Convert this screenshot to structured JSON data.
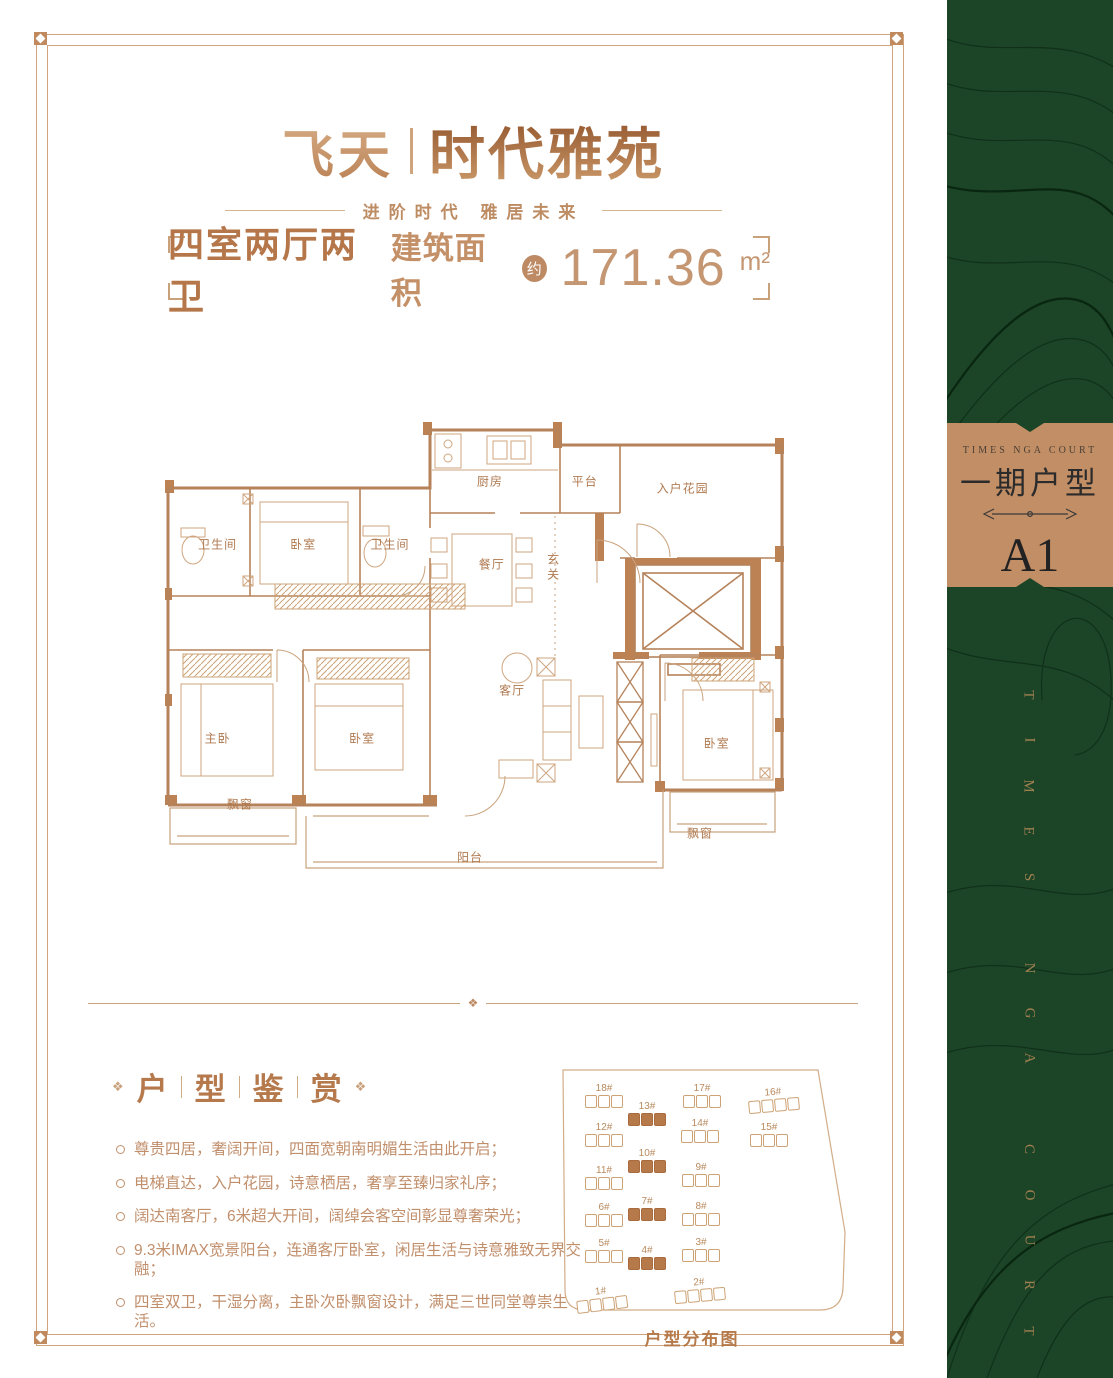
{
  "brand": {
    "name_left": "飞天",
    "name_right": "时代雅苑",
    "tagline": "进阶时代 雅居未来"
  },
  "spec": {
    "rooms_label": "四室两厅两卫",
    "area_label": "建筑面积",
    "approx": "约",
    "area_value": "171.36",
    "area_unit": "m²"
  },
  "floorplan": {
    "rooms": [
      {
        "label": "卫生间"
      },
      {
        "label": "卧室"
      },
      {
        "label": "卫生间"
      },
      {
        "label": "厨房"
      },
      {
        "label": "平台"
      },
      {
        "label": "入户花园"
      },
      {
        "label": "餐厅"
      },
      {
        "label": "玄关"
      },
      {
        "label": "主卧"
      },
      {
        "label": "卧室"
      },
      {
        "label": "客厅"
      },
      {
        "label": "卧室"
      },
      {
        "label": "飘窗"
      },
      {
        "label": "阳台"
      },
      {
        "label": "飘窗"
      }
    ]
  },
  "divider_ornament": "❖",
  "features": {
    "ornament": "❖",
    "heading": [
      "户",
      "型",
      "鉴",
      "赏"
    ],
    "items": [
      "尊贵四居，奢阔开间，四面宽朝南明媚生活由此开启；",
      "电梯直达，入户花园，诗意栖居，奢享至臻归家礼序；",
      "阔达南客厅，6米超大开间，阔绰会客空间彰显尊奢荣光；",
      "9.3米IMAX宽景阳台，连通客厅卧室，闲居生活与诗意雅致无界交融；",
      "四室双卫，干湿分离，主卧次卧飘窗设计，满足三世同堂尊崇生活。"
    ]
  },
  "siteplan": {
    "caption": "户型分布图",
    "buildings": [
      {
        "label": "18#",
        "filled": false
      },
      {
        "label": "13#",
        "filled": true
      },
      {
        "label": "17#",
        "filled": false
      },
      {
        "label": "16#",
        "filled": false
      },
      {
        "label": "12#",
        "filled": false
      },
      {
        "label": "14#",
        "filled": false
      },
      {
        "label": "15#",
        "filled": false
      },
      {
        "label": "10#",
        "filled": true
      },
      {
        "label": "11#",
        "filled": false
      },
      {
        "label": "9#",
        "filled": false
      },
      {
        "label": "6#",
        "filled": false
      },
      {
        "label": "7#",
        "filled": true
      },
      {
        "label": "8#",
        "filled": false
      },
      {
        "label": "5#",
        "filled": false
      },
      {
        "label": "4#",
        "filled": true
      },
      {
        "label": "3#",
        "filled": false
      },
      {
        "label": "1#",
        "filled": false
      },
      {
        "label": "2#",
        "filled": false
      }
    ]
  },
  "sidebar": {
    "badge": {
      "en": "TIMES NGA COURT",
      "cn": "一期户型",
      "unit": "A1"
    },
    "vertical_letters": [
      "T",
      "I",
      "M",
      "E",
      "S",
      "N",
      "G",
      "A",
      "C",
      "O",
      "U",
      "R",
      "T"
    ]
  },
  "colors": {
    "copper": "#bd8a64",
    "deep_copper": "#a9633a",
    "plan_line": "#b5825a",
    "wall_fill": "#bc8254",
    "green": "#1c4427",
    "badge_bg": "#c28e66"
  }
}
